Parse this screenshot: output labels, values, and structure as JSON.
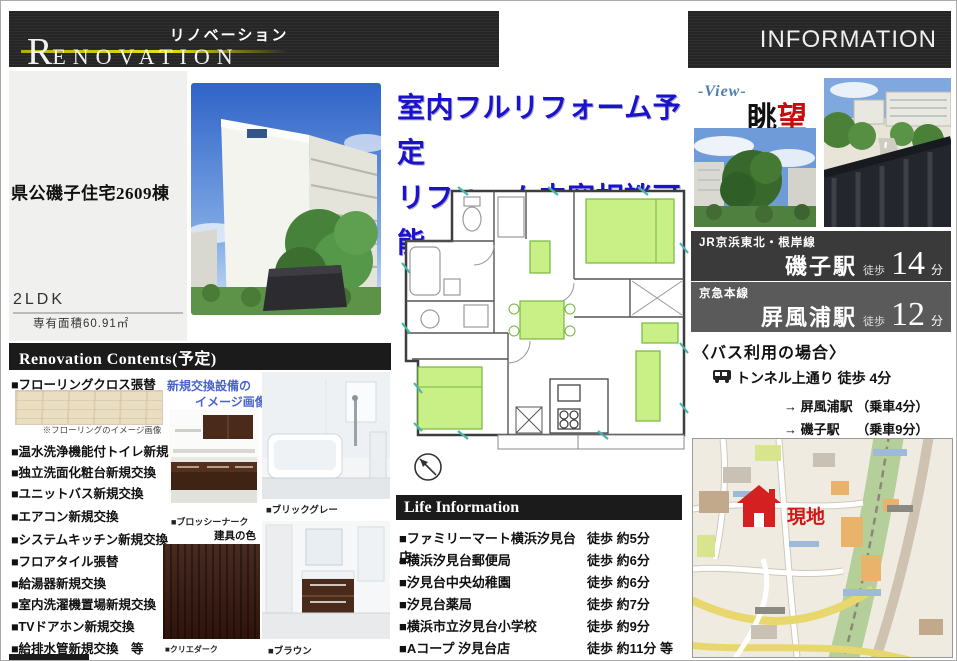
{
  "header": {
    "brand_kana": "リノベーション",
    "brand_initial": "R",
    "brand_rest": "ENOVATION",
    "info_label": "INFORMATION"
  },
  "property": {
    "name": "県公磯子住宅2609棟",
    "layout": "2LDK",
    "area": "専有面積60.91㎡"
  },
  "headline": {
    "line1": "室内フルリフォーム予定",
    "line2": "リフォーム内容相談可能"
  },
  "view": {
    "label_en": "-View-",
    "jp_black": "眺",
    "jp_red": "望"
  },
  "access": {
    "trains": [
      {
        "line": "JR京浜東北・根岸線",
        "station": "磯子駅",
        "walk": "徒歩",
        "minutes": "14",
        "unit": "分"
      },
      {
        "line": "京急本線",
        "station": "屏風浦駅",
        "walk": "徒歩",
        "minutes": "12",
        "unit": "分"
      }
    ],
    "bus": {
      "title": "〈バス利用の場合〉",
      "stop": "トンネル上通り 徒歩 4分",
      "route1": "→ 屏風浦駅 （乗車4分）",
      "route2": "→ 磯子駅　 （乗車9分）"
    }
  },
  "renovation": {
    "title": "Renovation Contents(予定)",
    "items": [
      "■フローリングクロス張替",
      "■温水洗浄機能付トイレ新規交換",
      "■独立洗面化粧台新規交換",
      "■ユニットバス新規交換",
      "■エアコン新規交換",
      "■システムキッチン新規交換",
      "■フロアタイル張替",
      "■給湯器新規交換",
      "■室内洗濯機置場新規交換",
      "■TVドアホン新規交換",
      "■給排水管新規交換　等"
    ],
    "flooring_caption": "※フローリングのイメージ画像",
    "note_line1": "新規交換設備の",
    "note_line2": "イメージ画像",
    "cap_kitchen": "■ブロッシーナーク",
    "fitting_title": "建具の色",
    "cap_fitting": "■クリエダーク",
    "cap_bath": "■ブリックグレー",
    "cap_vanity": "■ブラウン"
  },
  "life": {
    "title": "Life Information",
    "rows": [
      {
        "name": "■ファミリーマート横浜汐見台店",
        "time": "徒歩 約5分"
      },
      {
        "name": "■横浜汐見台郵便局",
        "time": "徒歩 約6分"
      },
      {
        "name": "■汐見台中央幼稚園",
        "time": "徒歩 約6分"
      },
      {
        "name": "■汐見台薬局",
        "time": "徒歩 約7分"
      },
      {
        "name": "■横浜市立汐見台小学校",
        "time": "徒歩 約9分"
      },
      {
        "name": "■Aコープ 汐見台店",
        "time": "徒歩 約11分 等"
      }
    ]
  },
  "map": {
    "marker_label": "現地"
  }
}
